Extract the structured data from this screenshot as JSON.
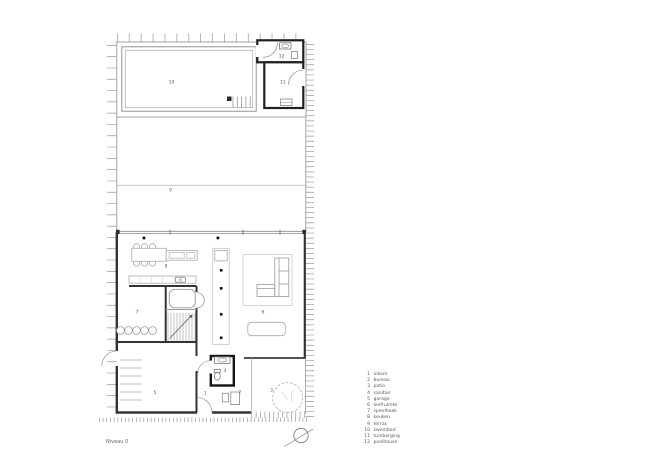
{
  "title": "Niveau 0",
  "legend": {
    "items": [
      {
        "number": "1",
        "label": "inkom"
      },
      {
        "number": "2",
        "label": "bureau"
      },
      {
        "number": "3",
        "label": "patio"
      },
      {
        "number": "4",
        "label": "sanitair"
      },
      {
        "number": "5",
        "label": "garage"
      },
      {
        "number": "6",
        "label": "leefruimte"
      },
      {
        "number": "7",
        "label": "speelhoek"
      },
      {
        "number": "8",
        "label": "keuken"
      },
      {
        "number": "9",
        "label": "terras"
      },
      {
        "number": "10",
        "label": "zwembad"
      },
      {
        "number": "11",
        "label": "tuinberging"
      },
      {
        "number": "12",
        "label": "poolhouse"
      }
    ]
  }
}
